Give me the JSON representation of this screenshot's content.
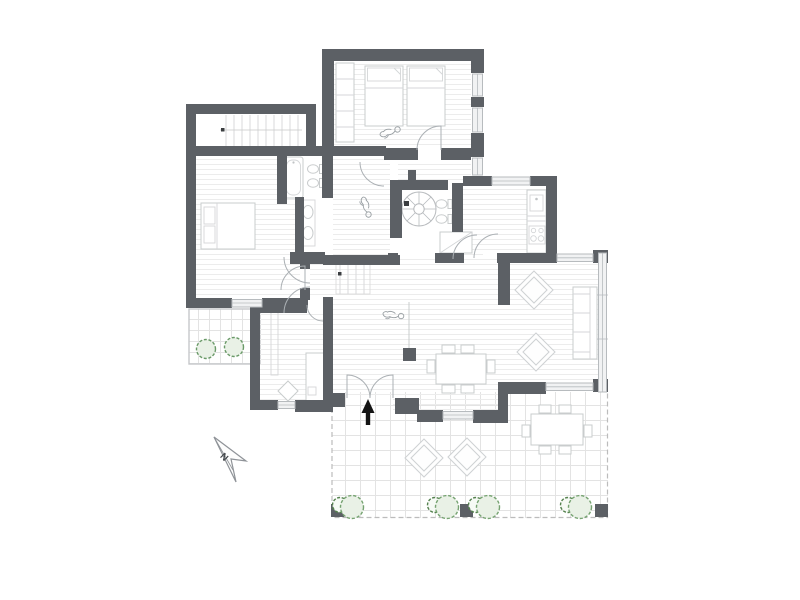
{
  "plan": {
    "compass_label": "N",
    "colors": {
      "wall": "#5c6065",
      "fixture_outline": "#c9cccd",
      "door_swing": "#abb0b4",
      "glass": "#b7bbbe",
      "floor_line": "#ececec",
      "tile_line": "#e3e3e3",
      "terrace_dash": "#bcbcbc",
      "plant_stroke_large": "#76a371",
      "plant_stroke_small": "#55824f",
      "plant_fill": "#e9f1e6",
      "entry_arrow": "#141414",
      "background": "#ffffff"
    },
    "rooms": [
      "staircase-hall",
      "twin-bedroom",
      "master-bedroom",
      "family-bathroom",
      "dressing-room",
      "spiral-staircase",
      "shower-wc",
      "kitchen",
      "living-dining-room",
      "study",
      "entrance-hall",
      "side-terrace",
      "main-terrace"
    ],
    "fixtures": [
      "twin-beds",
      "wardrobe",
      "double-bed",
      "bathtub",
      "wc",
      "bidet",
      "twin-washbasins",
      "shower-tray",
      "kitchen-counter",
      "sink",
      "hob",
      "sofa",
      "armchairs",
      "dining-table-6-chairs",
      "outdoor-dining-table",
      "outdoor-armchairs",
      "desk",
      "planters",
      "pergola-posts"
    ],
    "annotations": [
      "north-arrow",
      "entrance-arrow",
      "person-sketches"
    ]
  }
}
